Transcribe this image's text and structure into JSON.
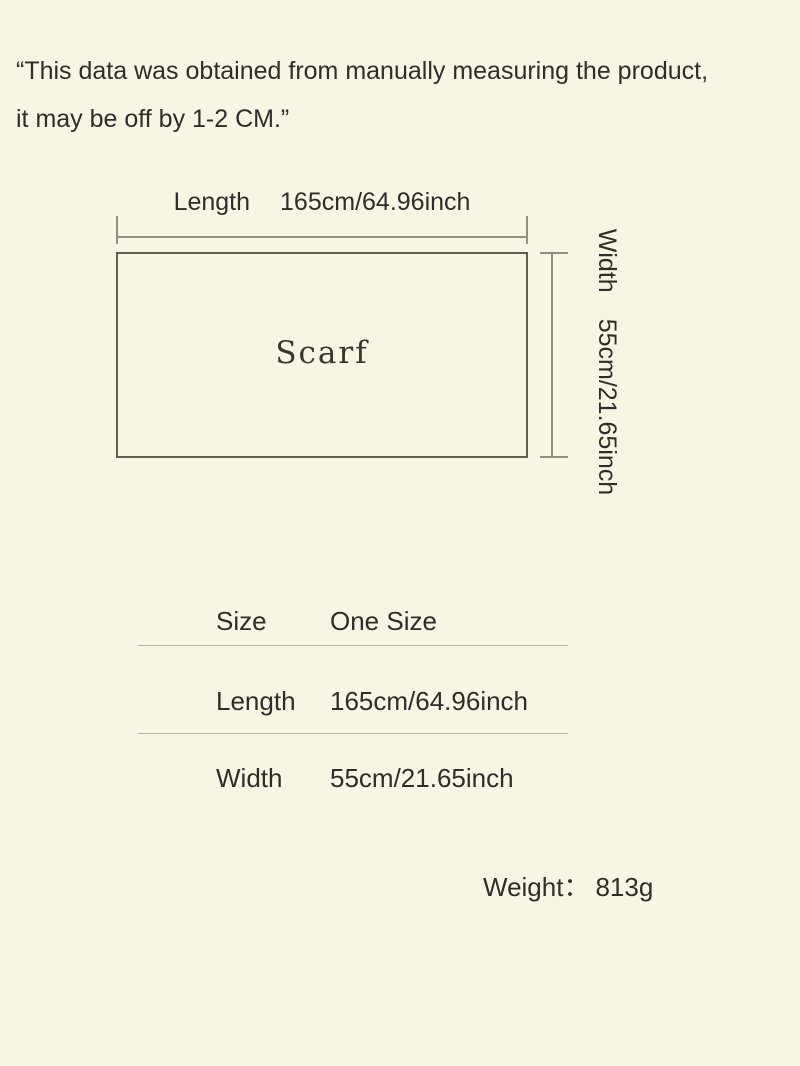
{
  "disclaimer": {
    "line1": "“This data was obtained from manually measuring the product,",
    "line2": "it may be off by 1-2 CM.”"
  },
  "diagram": {
    "length_label": "Length",
    "length_value": "165cm/64.96inch",
    "product_label": "Scarf",
    "width_label": "Width",
    "width_value": "55cm/21.65inch"
  },
  "size_table": {
    "rows": [
      {
        "label": "Size",
        "value": "One Size"
      },
      {
        "label": "Length",
        "value": "165cm/64.96inch"
      },
      {
        "label": "Width",
        "value": "55cm/21.65inch"
      }
    ]
  },
  "weight": {
    "label": "Weight：",
    "value": "813g"
  },
  "colors": {
    "background": "#f9f5e4",
    "text": "#2f2d29",
    "dimension_line": "#91907f",
    "rect_border": "#615d52",
    "table_divider": "#b5b3aa"
  }
}
